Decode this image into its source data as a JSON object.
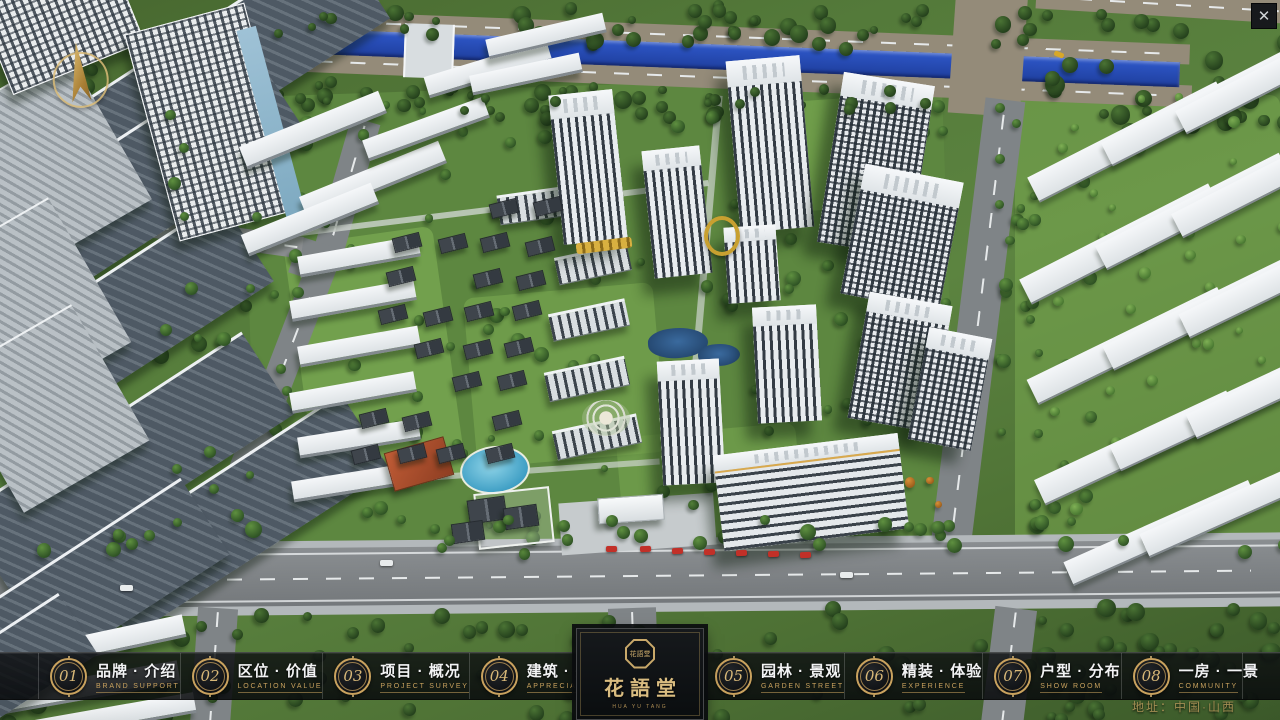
{
  "topbar": {
    "close_glyph": "✕"
  },
  "nav": {
    "items": [
      {
        "num": "01",
        "zh": "品牌 · 介绍",
        "en": "BRAND SUPPORT"
      },
      {
        "num": "02",
        "zh": "区位 · 价值",
        "en": "LOCATION VALUE"
      },
      {
        "num": "03",
        "zh": "项目 · 概况",
        "en": "PROJECT SURVEY"
      },
      {
        "num": "04",
        "zh": "建筑 · 鉴赏",
        "en": "APPRECIATION"
      },
      {
        "num": "05",
        "zh": "园林 · 景观",
        "en": "GARDEN STREET"
      },
      {
        "num": "06",
        "zh": "精装 · 体验",
        "en": "EXPERIENCE"
      },
      {
        "num": "07",
        "zh": "户型 · 分布",
        "en": "SHOW ROOM"
      },
      {
        "num": "08",
        "zh": "一房 · 一景",
        "en": "COMMUNITY"
      }
    ]
  },
  "logo": {
    "title": "花語堂",
    "seal_text": "花語堂",
    "subtitle": "HUA YU TANG"
  },
  "footer": {
    "address": "地址：中国·山西"
  },
  "colors": {
    "gold": "#c9a25e",
    "band_bg": "rgba(10,12,14,0.82)",
    "river_blue": "#2b52c0",
    "accent_red": "#c23028"
  },
  "scene": {
    "underlay": [
      [
        250,
        85,
        700,
        480,
        -2,
        "lawnA"
      ],
      [
        300,
        235,
        150,
        250,
        -8,
        "lawn2",
        0.7
      ],
      [
        470,
        290,
        190,
        170,
        -5,
        "lawn2",
        0.55
      ],
      [
        745,
        100,
        150,
        110,
        -4,
        "lawn2",
        0.6
      ],
      [
        1015,
        95,
        265,
        460,
        0,
        "lawn2",
        0.5
      ],
      [
        620,
        430,
        180,
        110,
        -5,
        "lawn2",
        0.5
      ],
      [
        225,
        26,
        965,
        20,
        2.2,
        "roadT roadH"
      ],
      [
        222,
        66,
        970,
        22,
        2.3,
        "roadT roadH"
      ],
      [
        228,
        44,
        952,
        25,
        2.2,
        "river"
      ],
      [
        952,
        -10,
        72,
        125,
        4,
        "roadT"
      ],
      [
        1036,
        -8,
        250,
        24,
        3.5,
        "roadT roadH"
      ],
      [
        404,
        24,
        46,
        54,
        2,
        "bridge"
      ],
      [
        956,
        98,
        40,
        484,
        7,
        "road roadV"
      ],
      [
        330,
        118,
        30,
        152,
        16,
        "road roadV"
      ],
      [
        266,
        252,
        30,
        242,
        21,
        "road roadV"
      ],
      [
        293,
        242,
        44,
        38,
        18,
        "road"
      ],
      [
        230,
        478,
        32,
        116,
        8,
        "road roadV"
      ],
      [
        148,
        226,
        155,
        22,
        8,
        "roadS roadH"
      ],
      [
        -10,
        538,
        1300,
        10,
        -0.5,
        "walk"
      ],
      [
        -10,
        545,
        1300,
        61,
        -0.5,
        "roadMain roadH"
      ],
      [
        -10,
        603,
        1300,
        9,
        -0.5,
        "walk"
      ],
      [
        194,
        608,
        40,
        118,
        4,
        "road roadV"
      ],
      [
        610,
        608,
        48,
        118,
        -2,
        "road roadV"
      ],
      [
        988,
        608,
        42,
        118,
        7,
        "road roadV"
      ],
      [
        560,
        498,
        155,
        52,
        -4,
        "walk2"
      ],
      [
        250,
        208,
        460,
        6,
        -7,
        "path",
        0.8
      ],
      [
        700,
        95,
        7,
        360,
        5,
        "path",
        0.7
      ],
      [
        330,
        470,
        330,
        6,
        -4,
        "path",
        0.7
      ]
    ],
    "trees1": [
      {
        "x": 240,
        "y": 0,
        "w": 920,
        "h": 42,
        "n": 46,
        "seed": 11,
        "p": "tD",
        "r0": 8,
        "r1": 18
      },
      {
        "x": 240,
        "y": 76,
        "w": 700,
        "h": 40,
        "n": 40,
        "seed": 22,
        "p": "tD",
        "r0": 8,
        "r1": 18
      },
      {
        "x": 1030,
        "y": 8,
        "w": 250,
        "h": 120,
        "n": 28,
        "seed": 33,
        "p": "tD",
        "r0": 10,
        "r1": 20
      },
      {
        "x": 0,
        "y": 60,
        "w": 240,
        "h": 580,
        "n": 42,
        "seed": 44,
        "p": "tD",
        "r0": 9,
        "r1": 18
      },
      {
        "x": 250,
        "y": 90,
        "w": 700,
        "h": 460,
        "n": 115,
        "seed": 55,
        "p": "tM",
        "r0": 7,
        "r1": 15
      },
      {
        "x": 995,
        "y": 95,
        "w": 90,
        "h": 470,
        "n": 34,
        "seed": 66,
        "p": "tM",
        "r0": 8,
        "r1": 15
      },
      {
        "x": 1040,
        "y": 90,
        "w": 240,
        "h": 455,
        "n": 36,
        "seed": 77,
        "p": "tL",
        "r0": 7,
        "r1": 13
      },
      {
        "x": 0,
        "y": 600,
        "w": 1280,
        "h": 115,
        "n": 60,
        "seed": 88,
        "p": "tD",
        "r0": 9,
        "r1": 18
      },
      {
        "x": 850,
        "y": 455,
        "w": 105,
        "h": 85,
        "n": 10,
        "seed": 99,
        "p": "tO",
        "r0": 6,
        "r1": 11
      }
    ],
    "buildings": [
      [
        60,
        18,
        330,
        95,
        -33,
        "slabD"
      ],
      [
        -50,
        140,
        360,
        100,
        -33,
        "slabD"
      ],
      [
        -70,
        285,
        345,
        95,
        -33,
        "slabD"
      ],
      [
        -40,
        415,
        335,
        95,
        -33,
        "slabD"
      ],
      [
        80,
        470,
        310,
        88,
        -33,
        "slabD"
      ],
      [
        -80,
        555,
        310,
        88,
        -33,
        "slabD"
      ],
      [
        -45,
        80,
        165,
        170,
        -30,
        "slabL"
      ],
      [
        -55,
        225,
        155,
        165,
        -30,
        "slabL"
      ],
      [
        -25,
        330,
        145,
        155,
        -30,
        "slabL"
      ],
      [
        -10,
        -25,
        140,
        95,
        -22,
        "towerGrid"
      ],
      [
        150,
        15,
        122,
        212,
        -15,
        "towerGrid"
      ],
      [
        262,
        25,
        20,
        200,
        -15,
        "glass"
      ],
      [
        238,
        118,
        150,
        21,
        -22,
        "slabW"
      ],
      [
        298,
        168,
        150,
        21,
        -22,
        "slabW"
      ],
      [
        240,
        208,
        140,
        20,
        -22,
        "slabW"
      ],
      [
        362,
        118,
        128,
        19,
        -20,
        "slabW"
      ],
      [
        424,
        58,
        128,
        19,
        -17,
        "slabW"
      ],
      [
        486,
        26,
        120,
        17,
        -13,
        "slabW"
      ],
      [
        470,
        64,
        112,
        17,
        -12,
        "slabW"
      ],
      [
        298,
        246,
        122,
        18,
        -10,
        "slabW"
      ],
      [
        290,
        290,
        126,
        18,
        -10,
        "slabW"
      ],
      [
        298,
        336,
        122,
        18,
        -10,
        "slabW"
      ],
      [
        290,
        382,
        126,
        18,
        -10,
        "slabW"
      ],
      [
        298,
        428,
        122,
        18,
        -9,
        "slabW"
      ],
      [
        292,
        472,
        122,
        18,
        -9,
        "slabW"
      ],
      [
        498,
        188,
        108,
        26,
        -8,
        "midrise"
      ],
      [
        556,
        250,
        74,
        24,
        -12,
        "midrise"
      ],
      [
        550,
        306,
        78,
        24,
        -12,
        "midrise"
      ],
      [
        546,
        364,
        82,
        26,
        -12,
        "midrise"
      ],
      [
        554,
        422,
        86,
        26,
        -12,
        "midrise"
      ],
      [
        460,
        446,
        66,
        44,
        -6,
        "pool"
      ],
      [
        388,
        444,
        60,
        38,
        -16,
        "redroof"
      ],
      [
        476,
        490,
        72,
        52,
        -6,
        "wallW"
      ],
      [
        468,
        498,
        36,
        22,
        -8,
        "house"
      ],
      [
        504,
        506,
        32,
        20,
        -8,
        "house"
      ],
      [
        452,
        522,
        30,
        18,
        -8,
        "house"
      ],
      [
        648,
        328,
        60,
        30,
        -4,
        "pond"
      ],
      [
        698,
        344,
        42,
        22,
        -4,
        "pond"
      ],
      [
        582,
        400,
        48,
        36,
        0,
        "plaza"
      ],
      [
        556,
        92,
        64,
        150,
        -6,
        "tw",
        0.16
      ],
      [
        648,
        148,
        58,
        128,
        -6,
        "tw",
        0.16
      ],
      [
        733,
        58,
        74,
        172,
        -5,
        "tw",
        0.15
      ],
      [
        830,
        78,
        92,
        172,
        9,
        "twG",
        0.14
      ],
      [
        852,
        172,
        100,
        132,
        11,
        "twG",
        0.2
      ],
      [
        726,
        226,
        52,
        76,
        -4,
        "tw",
        0.2
      ],
      [
        755,
        306,
        64,
        116,
        -3,
        "tw",
        0.16
      ],
      [
        858,
        298,
        84,
        128,
        10,
        "twG",
        0.16
      ],
      [
        918,
        332,
        64,
        114,
        11,
        "twG",
        0.18
      ],
      [
        660,
        360,
        62,
        124,
        -3,
        "tw",
        0.16
      ],
      [
        718,
        444,
        186,
        96,
        -7,
        "twH",
        0.17
      ],
      [
        1022,
        128,
        212,
        26,
        -27,
        "slabW2"
      ],
      [
        1096,
        96,
        202,
        24,
        -27,
        "slabW2"
      ],
      [
        1170,
        64,
        202,
        24,
        -27,
        "slabW2"
      ],
      [
        1014,
        230,
        212,
        26,
        -27,
        "slabW2"
      ],
      [
        1090,
        198,
        206,
        25,
        -27,
        "slabW2"
      ],
      [
        1166,
        166,
        206,
        25,
        -27,
        "slabW2"
      ],
      [
        1022,
        332,
        212,
        26,
        -26,
        "slabW2"
      ],
      [
        1098,
        300,
        206,
        25,
        -26,
        "slabW2"
      ],
      [
        1174,
        268,
        206,
        25,
        -26,
        "slabW2"
      ],
      [
        1030,
        434,
        212,
        26,
        -25,
        "slabW2"
      ],
      [
        1106,
        402,
        206,
        25,
        -25,
        "slabW2"
      ],
      [
        1182,
        370,
        206,
        25,
        -25,
        "slabW2"
      ],
      [
        1060,
        520,
        202,
        24,
        -24,
        "slabW2"
      ],
      [
        1136,
        492,
        202,
        24,
        -24,
        "slabW2"
      ],
      [
        14,
        632,
        172,
        20,
        -12,
        "slabW"
      ],
      [
        -2,
        676,
        182,
        20,
        -10,
        "slabW"
      ],
      [
        34,
        706,
        162,
        18,
        -10,
        "slabW"
      ],
      [
        -60,
        628,
        150,
        70,
        -33,
        "slabD"
      ],
      [
        598,
        496,
        64,
        24,
        -4,
        "canopy"
      ]
    ],
    "villas": {
      "x": 396,
      "y": 198,
      "cols": 4,
      "dx": 45,
      "rows": 8,
      "dy": 35,
      "shift": -7,
      "seed": 7,
      "skip": 0.15,
      "w": 26,
      "h": 13,
      "rot": -14
    },
    "trees2": [
      {
        "x": 0,
        "y": 514,
        "w": 1280,
        "h": 32,
        "n": 34,
        "seed": 111,
        "p": "tM",
        "r0": 9,
        "r1": 17
      },
      {
        "x": 240,
        "y": 6,
        "w": 900,
        "h": 24,
        "n": 14,
        "seed": 122,
        "p": "tD",
        "r0": 8,
        "r1": 14
      },
      {
        "x": 260,
        "y": 84,
        "w": 680,
        "h": 24,
        "n": 14,
        "seed": 133,
        "p": "tD",
        "r0": 8,
        "r1": 14
      },
      {
        "x": 1020,
        "y": 598,
        "w": 260,
        "h": 118,
        "n": 30,
        "seed": 144,
        "p": "tD",
        "r0": 10,
        "r1": 19
      },
      {
        "x": 150,
        "y": 100,
        "w": 110,
        "h": 420,
        "n": 16,
        "seed": 155,
        "p": "tM",
        "r0": 8,
        "r1": 14
      }
    ],
    "accents": [
      [
        606,
        546,
        11,
        6,
        0,
        "carR"
      ],
      [
        640,
        546,
        11,
        6,
        -2,
        "carR"
      ],
      [
        672,
        548,
        11,
        6,
        -2,
        "carR"
      ],
      [
        704,
        549,
        11,
        6,
        -2,
        "carR"
      ],
      [
        736,
        550,
        11,
        6,
        -2,
        "carR"
      ],
      [
        768,
        551,
        11,
        6,
        -2,
        "carR"
      ],
      [
        800,
        552,
        11,
        6,
        -2,
        "carR"
      ],
      [
        1054,
        52,
        10,
        5,
        22,
        "carY"
      ],
      [
        380,
        560,
        13,
        6,
        0,
        "carW"
      ],
      [
        840,
        572,
        13,
        6,
        0,
        "carW"
      ],
      [
        120,
        585,
        13,
        6,
        0,
        "carW"
      ],
      [
        704,
        216,
        28,
        32,
        0,
        "goldRing"
      ],
      [
        576,
        240,
        56,
        11,
        -7,
        "goldBar"
      ]
    ]
  }
}
